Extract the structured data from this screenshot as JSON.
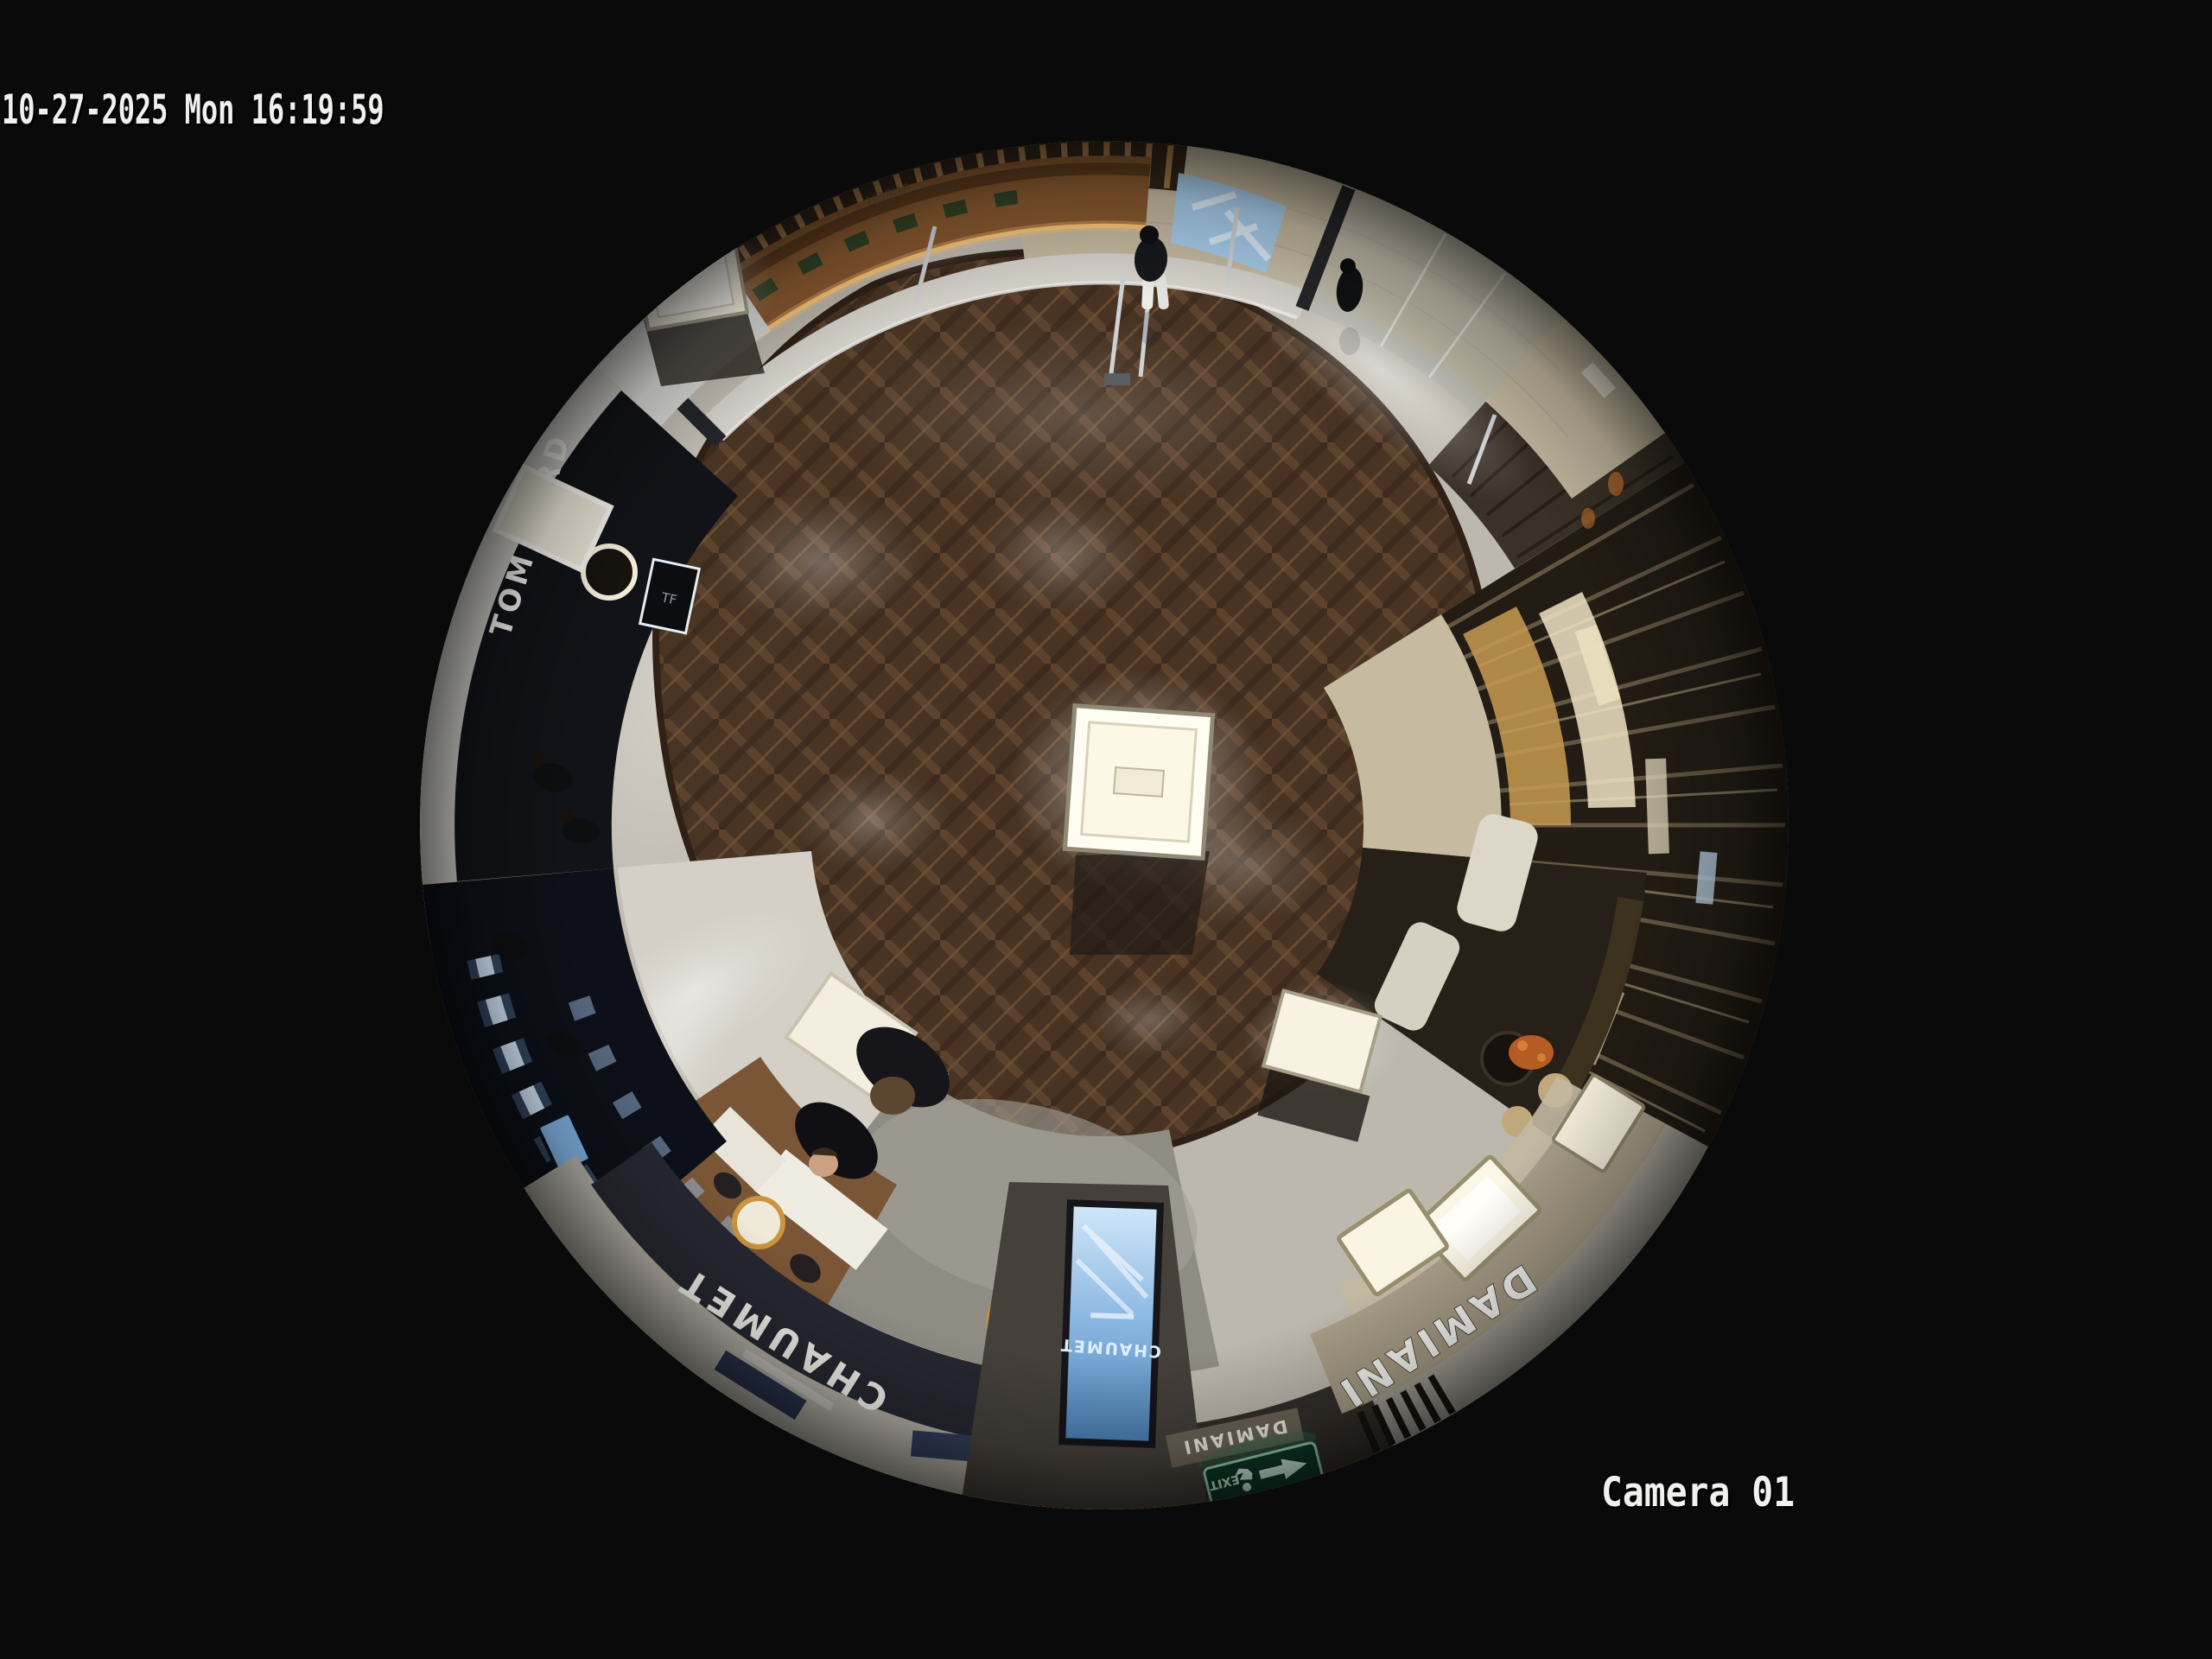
{
  "osd": {
    "timestamp": "10-27-2025 Mon 16:19:59",
    "camera": "Camera 01"
  },
  "signs": {
    "tom_ford": "TOM FORD",
    "tf_monogram": "TF",
    "chaumet_fascia": "CHAUMET",
    "chaumet_screen": "CHAUMET",
    "damiani_main": "DAMIANI",
    "damiani_entrance": "DAMIANI",
    "exit": "EXIT",
    "mirror_brand": "BURCH"
  },
  "icons": {
    "exit-runner-icon": "running-person pictogram",
    "exit-arrow-icon": "left arrow"
  },
  "colors": {
    "background": "#0a0a0a",
    "osd_text": "#f0f0ef",
    "wood_floor": "#46301f",
    "marble_floor": "#d2cec5",
    "mall_floor": "#c6bba2",
    "fascia_dark": "#262731",
    "tomford_black": "#121318",
    "damiani_beige": "#a89e88",
    "screen_blue": "#8fbbe4",
    "exit_green": "#0e3b28",
    "gold_accent": "#c9953e",
    "slat_brown": "#6b5e48"
  }
}
